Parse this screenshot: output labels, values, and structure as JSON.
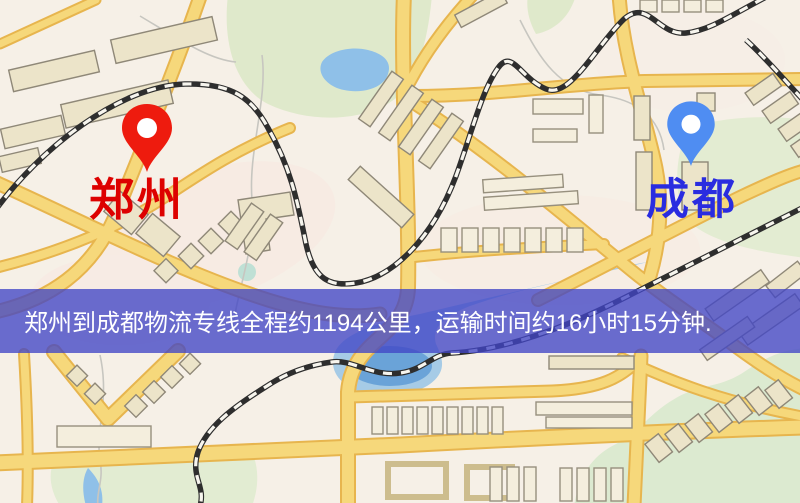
{
  "map": {
    "markers": [
      {
        "id": "origin",
        "label": "郑州",
        "pin_color": "#ee1b0e",
        "label_color": "#dd0100"
      },
      {
        "id": "destination",
        "label": "成都",
        "pin_color": "#4f8df2",
        "label_color": "#2a2ce0"
      }
    ]
  },
  "banner": {
    "text": "郑州到成都物流专线全程约1194公里，运输时间约16小时15分钟.",
    "bg_color": "#4145c5",
    "text_color": "#ffffff"
  },
  "palette": {
    "background": "#f6f0e7",
    "road": "#f6d87b",
    "road_casing": "#e7b54e",
    "building": "#ece4c9",
    "park": "#dfe9cb",
    "water": "#8fc0e8",
    "railway": "#2e2e2e"
  }
}
